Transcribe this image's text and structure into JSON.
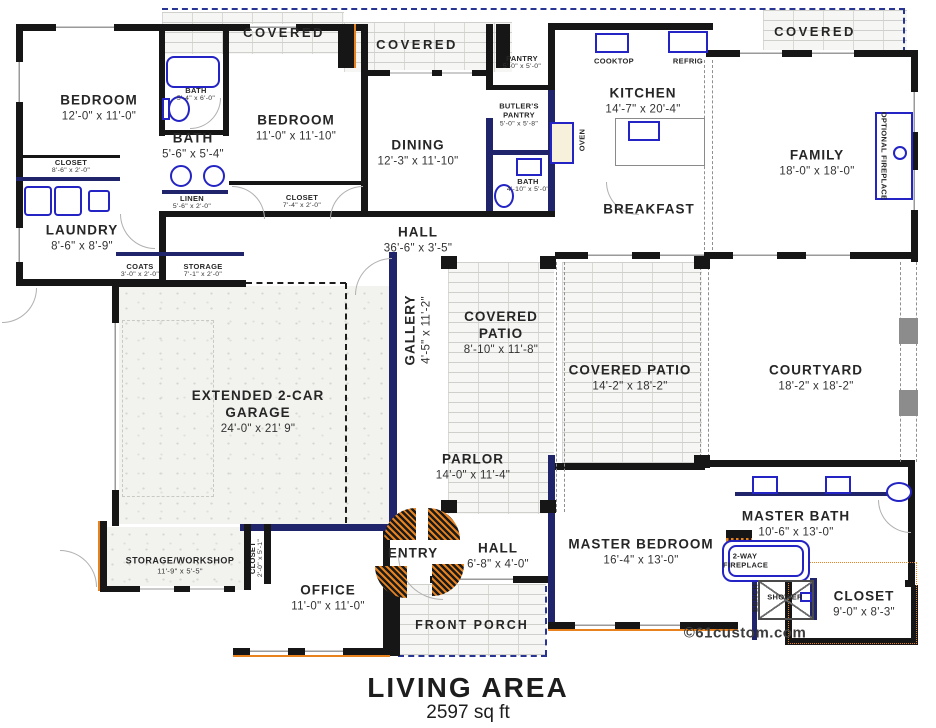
{
  "plan_title": "LIVING AREA",
  "plan_area": "2597 sq ft",
  "credit": "©61custom.com",
  "colors": {
    "wall": "#161616",
    "navy_wall": "#20246a",
    "fixture_blue": "#2424c4",
    "accent_orange": "#e8821e",
    "roofline_blue": "#283593",
    "brick_line": "#cfcfcb"
  },
  "rooms": {
    "bedroom1": {
      "name": "BEDROOM",
      "dims": "12'-0\" x 11'-0\""
    },
    "bath1_small": {
      "name": "BATH",
      "dims": "5'-4\" x 6'-0\""
    },
    "bath1": {
      "name": "BATH",
      "dims": "5'-6\" x 5'-4\""
    },
    "bedroom2": {
      "name": "BEDROOM",
      "dims": "11'-0\" x 11'-10\""
    },
    "closet1": {
      "name": "CLOSET",
      "dims": "8'-6\" x 2'-0\""
    },
    "linen": {
      "name": "LINEN",
      "dims": "5'-6\" x 2'-0\""
    },
    "closet2": {
      "name": "CLOSET",
      "dims": "7'-4\" x 2'-0\""
    },
    "laundry": {
      "name": "LAUNDRY",
      "dims": "8'-6\" x 8'-9\""
    },
    "covered_left": {
      "name": "COVERED"
    },
    "covered_mid": {
      "name": "COVERED"
    },
    "covered_right": {
      "name": "COVERED"
    },
    "dining": {
      "name": "DINING",
      "dims": "12'-3\" x 11'-10\""
    },
    "pantry": {
      "name": "PANTRY",
      "dims": "5'-0\" x 5'-0\""
    },
    "butlers_pantry": {
      "name": "BUTLER'S PANTRY",
      "dims": "5'-0\" x 5'-8\""
    },
    "bath2": {
      "name": "BATH",
      "dims": "4'-10\" x 5'-0\""
    },
    "kitchen": {
      "name": "KITCHEN",
      "dims": "14'-7\" x 20'-4\""
    },
    "cooktop": {
      "name": "COOKTOP"
    },
    "refrig": {
      "name": "REFRIG"
    },
    "oven": {
      "name": "OVEN"
    },
    "family": {
      "name": "FAMILY",
      "dims": "18'-0\" x 18'-0\""
    },
    "optional_fireplace": {
      "name": "OPTIONAL FIREPLACE"
    },
    "breakfast": {
      "name": "BREAKFAST"
    },
    "hall1": {
      "name": "HALL",
      "dims": "36'-6\" x 3'-5\""
    },
    "coats": {
      "name": "COATS",
      "dims": "3'-0\" x 2'-0\""
    },
    "storage_hall": {
      "name": "STORAGE",
      "dims": "7'-1\" x 2'-0\""
    },
    "gallery": {
      "name": "GALLERY",
      "dims": "4'-5\" x 11'-2\""
    },
    "covered_patio1": {
      "name": "COVERED PATIO",
      "dims": "8'-10\" x 11'-8\""
    },
    "covered_patio2": {
      "name": "COVERED PATIO",
      "dims": "14'-2\" x 18'-2\""
    },
    "courtyard": {
      "name": "COURTYARD",
      "dims": "18'-2\" x 18'-2\""
    },
    "garage": {
      "name": "EXTENDED 2-CAR GARAGE",
      "dims": "24'-0\" x 21' 9\""
    },
    "parlor": {
      "name": "PARLOR",
      "dims": "14'-0\" x 11'-4\""
    },
    "entry": {
      "name": "ENTRY"
    },
    "hall2": {
      "name": "HALL",
      "dims": "6'-8\" x 4'-0\""
    },
    "master_bedroom": {
      "name": "MASTER BEDROOM",
      "dims": "16'-4\" x 13'-0\""
    },
    "master_bath": {
      "name": "MASTER BATH",
      "dims": "10'-6\" x 13'-0\""
    },
    "two_way_fireplace": {
      "name": "2-WAY FIREPLACE"
    },
    "bench": {
      "name": "BENCH"
    },
    "shower": {
      "name": "SHOWER"
    },
    "master_closet": {
      "name": "CLOSET",
      "dims": "9'-0\" x 8'-3\""
    },
    "storage_workshop": {
      "name": "STORAGE/WORKSHOP",
      "dims": "11'-9\" x 5'-5\""
    },
    "office_closet": {
      "name": "CLOSET",
      "dims": "2'-0\" x 5'-1\""
    },
    "office": {
      "name": "OFFICE",
      "dims": "11'-0\" x 11'-0\""
    },
    "front_porch": {
      "name": "FRONT PORCH"
    }
  }
}
